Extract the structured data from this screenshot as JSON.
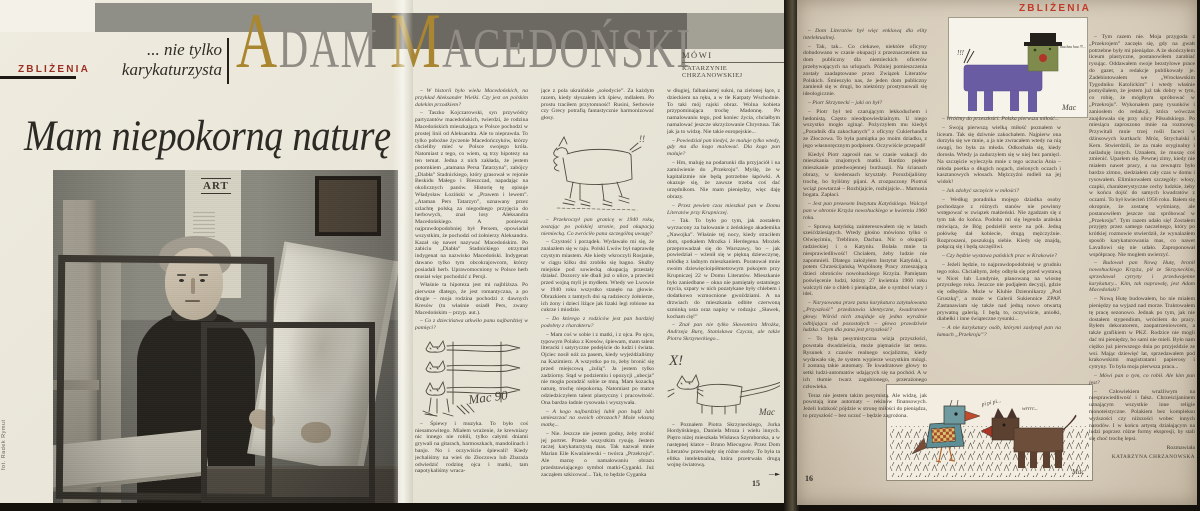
{
  "magazine": {
    "section_label_left": "ZBLIŻENIA",
    "section_label_right": "ZBLIŻENIA",
    "kicker_line1": "... nie tylko",
    "kicker_line2": "karykaturzysta",
    "title": "Mam niepokorną naturę",
    "photo_credit": "fot. Radek Rymut",
    "poster_title": "ART"
  },
  "headline": {
    "word1_initial": "A",
    "word1_rest": "DAM",
    "word2_initial": "M",
    "word2_rest": "ACEDOŃSKI",
    "speaks_label": "MÓWI",
    "interviewer": "KATARZYNIE CHRZANOWSKIEJ",
    "accent_color": "#a9862f",
    "letter_color": "#908c85"
  },
  "sketches": {
    "cats_sig": "Mac 90",
    "dog_marks": "!!",
    "longcat_x": "X!",
    "longcat_sig": "Mac",
    "hau_marks": "!!!",
    "hau_text": "hau hau hau !!!...",
    "hau_sig": "Mac",
    "bird_song": "pi pi pi...",
    "dog_growl": "wrrrr...",
    "birddog_sig": "Mac"
  },
  "page15": {
    "number": "15",
    "col1": [
      {
        "s": "q",
        "t": "– W historii było wielu Macedońskich, na przykład Aleksander Wielki. Czy jest on polskim dalekim przodkiem?"
      },
      {
        "s": "p",
        "t": "– Taszko Kojczarowski, syn przywódcy partyzantów macedońskich, twierdzi, że rodzina Macedońskich mieszkająca w Polsce pochodzi w prostej linii od Aleksandra. Ale to nieprawda. To tylko pobożne życzenie Macedończyków, którzy chcieliby mieć w Polsce swojego króla. Natomiast z tego, co wiem, są trzy hipotezy na ten temat. Jedna z nich zakłada, że jestem potomkiem „atamana Persa Tatarzyna”, zabójcy „Diabła” Stadnickiego, który grasował w rejonie Beskidu Małego i Bieszczad, napadając na okolicznych panów. Historię tę opisuje Władysław Łoziński w „Prawem i lewem”. „Ataman Pers Tatarzyn”, uznawany przez szlachtę polską za niegodnego przyjęcia do herbowych, znał losy Aleksandra Macedońskiego. A ponieważ najprawdopodobniej był Persem, opowiadał wszystkim, że pochodzi od żołnierzy Aleksandra. Kazał się nawet nazywać Macedońskim. Po zabiciu „Diabła” Stadnickiego otrzymał indygenat na nazwisko Macedoński. Indygenat dawano tylko tym obcokrajowcom, którzy posiadali herb. Uprawomocniony w Polsce herb musiał więc pochodzić z Persji."
      },
      {
        "s": "p",
        "t": "Właśnie ta hipoteza jest mi najbliższa. Po pierwsze dlatego, że jest romantyczna, a po drugie – moja rodzina pochodzi z dawnych Kresów (tu właśnie osiadł Pers, zwany Macedońskim – przyp. aut.)."
      },
      {
        "s": "q",
        "t": "– Co z dzieciństwa utkwiło panu najbardziej w pamięci?"
      },
      {
        "d": "sketch-cats"
      },
      {
        "s": "p",
        "t": "– Śpiewy i muzyka. To było coś niesamowitego. Miałem wrażenie, że krewniacy nic innego nie robili, tylko całymi dniami grywali na gitarach, harmoszkach, mandolinach i banjo. No i oczywiście śpiewali! Kiedy jechaliśmy na wieś do Złoczowa lub Zbaraża odwiedzić rodzinę ojca i matki, tam napotykaliśmy wraca-"
      }
    ],
    "col2": [
      {
        "s": "pc",
        "t": "jące z pola ukraińskie „sołodycie”. Za każdym razem, kiedy słyszałem ich śpiew, mdlałem. Po prostu traciłem przytomność! Rusini, Serbowie czy Grecy potrafią fantastycznie harmonizować głosy."
      },
      {
        "d": "sketch-dog"
      },
      {
        "s": "q",
        "t": "– Przekroczył pan granicę w 1940 roku, zostając po polskiej stronie, pod okupacją niemiecką. Co zwróciło pana szczególną uwagę?"
      },
      {
        "s": "p",
        "t": "– Czystość i porządek. Wydawało mi się, że znalazłem się w raju. Polski Lwów był naprawdę czystym miastem. Ale kiedy wkroczyli Rosjanie, w ciągu kilku dni zrobiło się bagno. Służby miejskie pod sowiecką okupacją przestały działać. Dozorcy nie dbali już o ulice, a przecież przed wojną myli je mydłem. Wtedy we Lwowie w 1940 roku wszystko stanęło na głowie. Obrazkiem z tamtych dni są radzieccy żołnierze, ich żony i dzieci liżące jak lizaki legi robione na cukrze i miodzie."
      },
      {
        "s": "q",
        "t": "– Do którego z rodziców jest pan bardziej podobny z charakteru?"
      },
      {
        "s": "p",
        "t": "– Mam coś w sobie i z matki, i z ojca. Po ojcu, typowym Polaku z Kresów, śpiewam, mam talent literacki i satyryczne podejście do ludzi i świata. Ojciec nosił nóż za pasem, kiedy wyjeżdżaliśmy na Kazimierz. A wszystko po to, żeby bronić się przed miejscową „żulią”. Ja jestem tylko zadziorny. Stąd w podziemiu i opozycji „ubecja” nie mogła poradzić sobie ze mną. Mam kozacką naturę, trochę niepokorną. Natomiast po matce odziedziczyłem talent plastyczny i pracowitość. Ona bardzo ładnie rysowała i wyszywała."
      },
      {
        "s": "q",
        "t": "– A kogo najbardziej lubił pan bądź lubi umieszczać na swoich obrazach? Może własną matkę..."
      },
      {
        "s": "p",
        "t": "– Nie. Jeszcze nie jestem godny, żeby zrobić jej portret. Przede wszystkim rysuję. Jestem raczej karykaturzystą mas. Tak nazwał mnie Marian Eile Kwaśniewski – twórca „Przekroju”. Ale marzę o namalowaniu obrazu przedstawiającego symbol matki-Cyganki. Już zacząłem szkicować... Tak, to będzie Cyganka"
      }
    ],
    "col3": [
      {
        "s": "pc",
        "t": "w długiej, falbaniastej sukni, na zielonej łące, z dzieckiem na ręku, a w tle Karpaty Wschodnie. To taki mój rajski obraz. Wolna kobieta przypominająca trochę Madonnę. Po namalowaniu tego, pod koniec życia, chciałbym namalować jeszcze ukrzyżowanie Chrystusa. Tak jak ja to widzę. Nie takie europejskie..."
      },
      {
        "s": "q",
        "t": "– Powiedział pan kiedyś, że maluje tylko wtedy, gdy ma dla kogo malować. Dla kogo pan maluje?"
      },
      {
        "s": "p",
        "t": "– Hm, maluję na podarunki dla przyjaciół i na zamówienie do „Przekroju”. Myślę, że w kapitalizmie nie będą potrzebne łapówki. A okazuje się, że zawsze trzeba coś dać urzędnikom. Nie mam pieniędzy, więc daję obrazy."
      },
      {
        "s": "q",
        "t": "– Przez pewien czas mieszkał pan w Domu Literatów przy Krupniczej."
      },
      {
        "s": "p",
        "t": "– Tak. To było po tym, jak zostałem wyrzucony za balowanie z żeńskiego akademika „Nawojka”. Właśnie tej nocy, kiedy straciłem dom, spotkałem Mrożka i Herdegena. Mrożek przeprowadzał się do Warszawy, bo – jak powiedział – wżenił się w piękną dziewczynę, młódkę z ładnym mieszkaniem. Poratował mnie swoim dziewięcioipółmetrowym pokojem przy Krupniczej 22 w Domu Literatów. Mieszkanie było zaniedbane – okna nie pamiętały ostatniego mycia, szpary w nich pozatykane były chlebem i dodatkowo wzmocnione gwoździami. A na drzwiach do mieszkania odbite czerwoną szminką usta oraz napisy w rodzaju: „Sławek, kocham cię!”"
      },
      {
        "s": "q",
        "t": "– Znał pan nie tylko Sławomira Mrożka, Andrzeja Burę, Stanisława Czycza, ale także Piotra Skrzyneckiego..."
      },
      {
        "d": "sketch-longcat"
      },
      {
        "s": "p",
        "t": "– Poznałem Piotra Skrzyneckiego, Jurka Hordyńskiego, Daniela Mroza i wielu innych. Piętro niżej mieszkała Wisława Szymborska, a w następnej klatce – Bruno Miecugow. Przez Dom Literatów przewinęły się różne osoby. To była ta elitka intelektualna, która przetrwała drugą wojnę światową."
      },
      {
        "s": "arrow",
        "t": "—►"
      }
    ]
  },
  "page16": {
    "number": "16",
    "col1": [
      {
        "s": "q",
        "t": "– Dom Literatów był więc enklawą dla elity intelektualnej."
      },
      {
        "s": "p",
        "t": "– Tak, tak... Co ciekawe, niektóre oficyny dobudowano w czasie okupacji z przeznaczeniem na dom publiczny dla niemieckich oficerów przebywających na urlopach. Później pomieszczenia zostały zaadaptowane przez Związek Literatów Polskich. Śmieszyło nas, że jeden dom publiczny zamienił się w drugi, bo niektórzy prostytuowali się ideologicznie."
      },
      {
        "s": "q",
        "t": "– Piotr Skrzynecki – jaki on był?"
      },
      {
        "s": "p",
        "t": "– Piotr był też czarującym lekkoduchem i hedonistą. Często nieodpowiedzialnym. U niego wszystko mogło zginąć. Pożyczyłem mu kiedyś „Poradnik dla zakochanych” z oficyny Cukierhandla ze Złoczowa. To była pamiątka po moim dziadku, z jego własnoręcznym podpisem. Oczywiście przepadł!"
      },
      {
        "s": "p",
        "t": "Kiedyś Piotr zaprosił nas w czasie wakacji do mieszkania znajomych matki. Bardzo piękne mieszkanie przedwojennej burżuazji. Na ścianach obrazy, w kredensach kryształy. Porozbijaliśmy trochę, bo byliśmy pijani. A zrozpaczony Piotruś wciąż powtarzał – Rozbijajcie, rozbijajcie... Mamusia bogata. Zapłaci."
      },
      {
        "s": "q",
        "t": "– Jest pan prezesem Instytutu Katyńskiego. Walczył pan w obronie Krzyża nowohuckiego w kwietniu 1960 roku."
      },
      {
        "s": "p",
        "t": "– Sprawą katyńską zainteresowałem się w latach sześćdziesiątych. Wtedy głośno mówiono tylko o Oświęcimiu, Treblince, Dachau. Nic o okupacji radzieckiej i o Katyniu. Bolała mnie ta niesprawiedliwość! Chciałem, żeby ludzie nie zapomnieli. Dlatego założyłem Instytut Katyński, a potem Chrześcijańską Wspólnotę Pracy zrzeszającą dzieci obrońców nowohuckiego Krzyża. Pamiętam poświęcenie ludzi, którzy 27 kwietnia 1960 roku walczyli nie o chleb i pieniądze, ale o symbol wiary i idei."
      },
      {
        "s": "q",
        "t": "– Narysowana przez pana karykatura zatytułowana „Przyszłość” przedstawia identyczne, kwadratowe głowy. Wśród nich znajduje się jedna wyraźnie odbijająca od pozostałych – głowa prawdziwie ludzka. Czym dla pana jest przyszłość?"
      },
      {
        "s": "p",
        "t": "– To była pesymistyczna wizja przyszłości, powstała dwadzieścia, może piętnaście lat temu. Rysunek z czasów realnego socjalizmu, kiedy wydawało się, że system wypierze wszystkim mózgi. I zostaną takie automaty. Te kwadratowe głowy to setki ludzi-automatów udających się na pochód. A w ich tłumie twarz zagubionego, przerażonego człowieka."
      },
      {
        "s": "p",
        "t": "Teraz nie jestem takim pesymistą. Ale widzę, jak powstają inne automaty – rekinów finansowych. Jeżeli ludzkość pójdzie w stronę miłości do pieniądza, to przyszłość – bez uczuć – będzie zagrożona."
      }
    ],
    "col2": [
      {
        "s": "q",
        "t": "– Wróćmy do przeszłości. Polska pierwsza miłość..."
      },
      {
        "s": "p",
        "t": "– Swoją pierwszą wielką miłość poznałem w liceum. Tak się dziwnie zakochałem. Najpierw ona durzyła się we mnie, a ja nie zwracałem wtedy na nią uwagi, bo była za młoda. Odkochała się, kiedy dorosła. Wtedy ja zadurzyłem się w niej bez pamięci. Na szczęście wyleczyła mnie z tego uczucia Ania – młoda poetka o długich nogach, zielonych oczach i kasztanowych włosach. Mężczyźni mdleli na jej widok!"
      },
      {
        "s": "q",
        "t": "– Jak zdobyć szczęście w miłości?"
      },
      {
        "s": "p",
        "t": "– Według poradnika mojego dziadka osoby pochodzące z różnych stanów nie powinny wstępować w związek małżeński. Nie zgadzam się z tym tak do końca. Podoba mi się legenda arabska mówiąca, że Bóg podzielił serce na pół. Jedną połówkę dał kobiecie, drugą mężczyźnie. Rozproszeni, poszukują siebie. Kiedy się znajdą, połączą się i będą szczęśliwi."
      },
      {
        "s": "q",
        "t": "– Czy będzie wystawa pańskich prac w Krakowie?"
      },
      {
        "s": "p",
        "t": "– Jeżeli będzie, to najprawdopodobniej w grudniu tego roku. Chciałbym, żeby odbyła się przed wystawą w Nicei lub Londynie, planowaną na wiosnę przyszłego roku. Jeszcze nie podjąłem decyzji, gdzie się odbędzie. Może w Klubie Dziennikarzy „Pod Gruszką”, a może w Galerii Sukiennice ZPAP. Zastanawiam się także nad jedną nowo otwartą prywatną galerią. I będą to, oczywiście, aniołki, diabełki i inne świąteczne rysunki..."
      },
      {
        "s": "q",
        "t": "– A nie karykatury osób, którymi zasłynął pan na łamach „Przekroju”?"
      }
    ],
    "col3": [
      {
        "s": "p",
        "t": "– Tym razem nie. Moja przygoda z „Przekrojem” zaczęła się, gdy na gwałt potrzebne były mi pieniądze. A że skończyłem liceum plastyczne, postanowiłem zarabiać rysując. Oddawałem swoje bezstylowe prace do gazet, a redakcje publikowały je. Zadebiutowałem we „Wrocławskim Tygodniku Katolickim” i wtedy właśnie pomyślałem, że jestem już tak dobry w tym, co robię, że mógłbym spróbować w „Przekroju”. Wykonałem parę rysunków i zaniosłem do redakcji, która wówczas znajdowała się przy ulicy Piłsudskiego. Po miesiącu zaproszono mnie na rozmowę. Przywitali mnie trzej rośli faceci w dżinsowych kurtkach: Mróz, Strychalski i Kern. Stwierdzili, że za mało oryginalny i naśladuję innych. Uznałem, że muszę coś zmienić. Uparłem się. Pewnej zimy, kiedy nie miałem nawet pracy, a na zewnątrz było bardzo zimno, siedziałem cały czas w domu i rysowałem. Eliminowałem szczegóły: włosy, czapki, charakterystyczne cechy ludzkie, żeby w końcu dojść do samych kwadratów z oczami. To był kwiecień 1956 roku. Bałem się okropnie, że zostanę wyśmiany, ale postanowiłem jeszcze raz spróbować w „Przekroju”. Tym razem udało się! Zostałem przyjęty przez samego naczelnego, który po krótkiej rozmowie stwierdził, że wynalazłem sposób karykaturowania mas, co nawet Lavallowi się nie udało. Zaproponował współpracę. Nie mogłem uwierzyć."
      },
      {
        "s": "q",
        "t": "– Budował pan Nową Hutę, bronił nowohuckiego Krzyża, pił ze Skrzyneckim, sprzedawał cytryny i przedwojenne karykatury... Kim, tak naprawdę, jest Adam Macedoński?"
      },
      {
        "s": "p",
        "t": "– Nową Hutę budowałem, bo nie miałem pieniędzy na wyjazd nad morze. Traktowałem tę pracę sezonowo. Jednak po tym, jak nie dostałem stypendium, wróciłem do pracy. Byłem dekoratorem, zaopatrzeniowcem, a także grafikiem w PKZ. Rodzice nie mogli dać mi pieniędzy, bo sami nie mieli. Było nam ciężko już pierwszego dnia po przyjeździe ze wsi. Mając dziewięć lat, sprzedawałem pod krakowskimi magistratami papierosy i cytryny. To była moja pierwsza praca..."
      },
      {
        "s": "q",
        "t": "– Mówi pan o tym, co robił. Ale kim pan jest?"
      },
      {
        "s": "p",
        "t": "– Człowiekiem wrażliwym na niesprawiedliwość i fałsz. Chrześcijaninem uznającym wszystkie inne religie monoteistyczne. Polakiem bez kompleksu wyższości czy niższości wobec innych narodów. I w końcu artystą działającym na ludzi poprzez różne formy ekspresji, by stali się choć trochę lepsi."
      },
      {
        "s": "role",
        "t": "Rozmawiała"
      },
      {
        "s": "name",
        "t": "KATARZYNA CHRZANOWSKA"
      }
    ]
  }
}
